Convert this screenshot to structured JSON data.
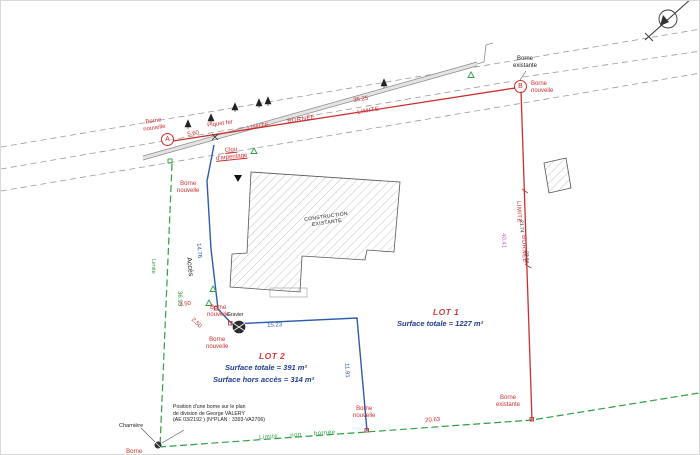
{
  "colors": {
    "boundary_red": "#cc2f2f",
    "limit_green": "#2f9e44",
    "access_blue": "#2b5cad",
    "surface_text_blue": "#1f3d8f",
    "dim_magenta": "#c65fc6",
    "road_gray": "#999999"
  },
  "icons": {
    "north_arrow": "north-arrow"
  },
  "points": {
    "a": "A",
    "b": "B"
  },
  "lots": {
    "lot1": {
      "title": "LOT 1",
      "surface_totale": "Surface totale = 1227 m²"
    },
    "lot2": {
      "title": "LOT 2",
      "surface_totale": "Surface totale = 391 m²",
      "surface_hors_acces": "Surface hors accès = 314 m²"
    }
  },
  "labels": {
    "borne_nouvelle": "Borne\nnouvelle",
    "borne_existante": "Borne\nexistante",
    "piquet_fer": "Piquet fer",
    "clou_arpentage": "Clou\nd'arpentage",
    "charniere": "Charnière",
    "gravier": "Gravier",
    "construction_existante": "CONSTRUCTION\nEXISTANTE",
    "acces": "Accès",
    "limite": "Limite",
    "limite_caps": "LIMITE",
    "bornee_caps": "BORNÉE",
    "limite_non_bornee": "Limite  non  bornée"
  },
  "dimensions": {
    "d_5_60": "5.60",
    "d_35_25": "35.25",
    "d_40_41": "40.41",
    "d_21_74": "21.74",
    "d_23_56": "23.56",
    "d_14_76": "14.76",
    "d_36_93": "36.93",
    "d_3_50": "3.50",
    "d_2_50": "2.50",
    "d_15_23": "15.23",
    "d_11_91": "11.91",
    "d_20_63": "20.63"
  },
  "note": {
    "text": "Position d'une borne sur le plan\nde division de George VALERY\n(AE 03/2192 ) (N°PLAN : 3393-VA2706)"
  }
}
